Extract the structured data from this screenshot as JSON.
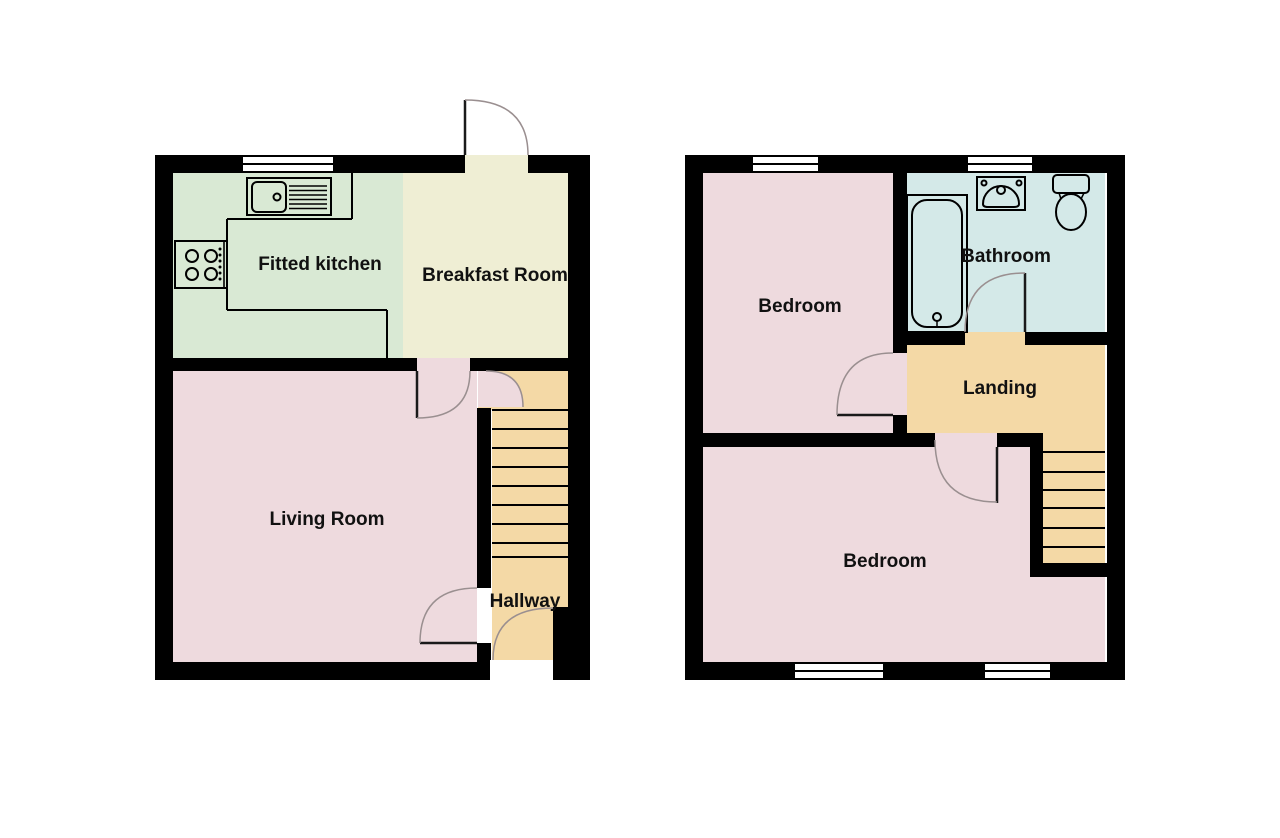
{
  "document": {
    "type": "floorplan",
    "floor_count": 2
  },
  "colors": {
    "background": "#ffffff",
    "wall": "#000000",
    "line": "#000000",
    "door_arc": "#9a8f90",
    "door_leaf": "#1a1a1a",
    "window_fill": "#ffffff",
    "text": "#111111",
    "kitchen": "#d9e9d4",
    "breakfast": "#efeed4",
    "pink_room": "#eedade",
    "tan_circulation": "#f4d9a6",
    "bathroom": "#d4e9e8"
  },
  "floors": {
    "ground": {
      "name": "ground-floor",
      "rooms": {
        "kitchen": {
          "label": "Fitted kitchen"
        },
        "breakfast": {
          "label": "Breakfast Room"
        },
        "living": {
          "label": "Living Room"
        },
        "hallway": {
          "label": "Hallway"
        }
      },
      "fixtures": [
        "kitchen-sink-icon",
        "hob-icon",
        "staircase",
        "entrance-door",
        "front-door"
      ],
      "window_count": 1,
      "door_count": 5
    },
    "first": {
      "name": "first-floor",
      "rooms": {
        "bedroom1": {
          "label": "Bedroom"
        },
        "bathroom": {
          "label": "Bathroom"
        },
        "landing": {
          "label": "Landing"
        },
        "bedroom2": {
          "label": "Bedroom"
        }
      },
      "fixtures": [
        "bathtub-icon",
        "wash-basin-icon",
        "toilet-icon",
        "staircase"
      ],
      "window_count": 4,
      "door_count": 3
    }
  }
}
